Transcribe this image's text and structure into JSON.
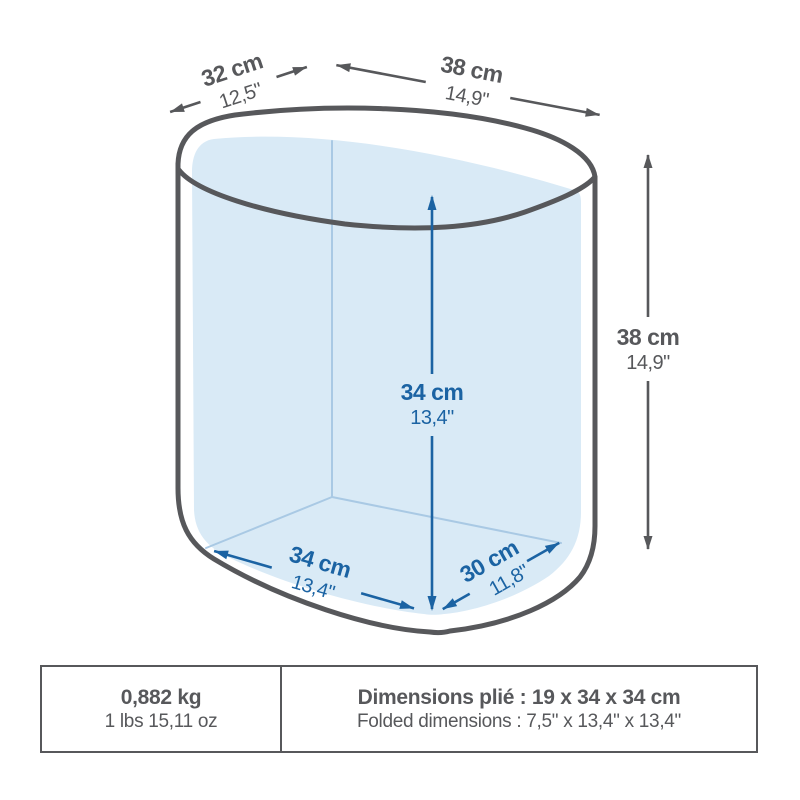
{
  "illustration": {
    "kind": "foldable-container-dimension-diagram",
    "colors": {
      "outline_gray": "#57585b",
      "dimension_blue": "#1b63a3",
      "interior_fill": "#d9eaf6",
      "interior_edge": "#a9c9e4"
    },
    "dimensions": {
      "top_depth": {
        "cm": "32 cm",
        "inches": "12,5\""
      },
      "top_width": {
        "cm": "38 cm",
        "inches": "14,9\""
      },
      "outer_height": {
        "cm": "38 cm",
        "inches": "14,9\""
      },
      "inner_height": {
        "cm": "34 cm",
        "inches": "13,4\""
      },
      "floor_width": {
        "cm": "34 cm",
        "inches": "13,4\""
      },
      "floor_depth": {
        "cm": "30 cm",
        "inches": "11,8\""
      }
    }
  },
  "spec_table": {
    "weight": {
      "metric": "0,882 kg",
      "imperial": "1 lbs 15,11 oz"
    },
    "folded": {
      "metric": "Dimensions plié : 19 x 34 x 34 cm",
      "imperial": "Folded dimensions : 7,5\" x 13,4\" x 13,4\""
    }
  }
}
